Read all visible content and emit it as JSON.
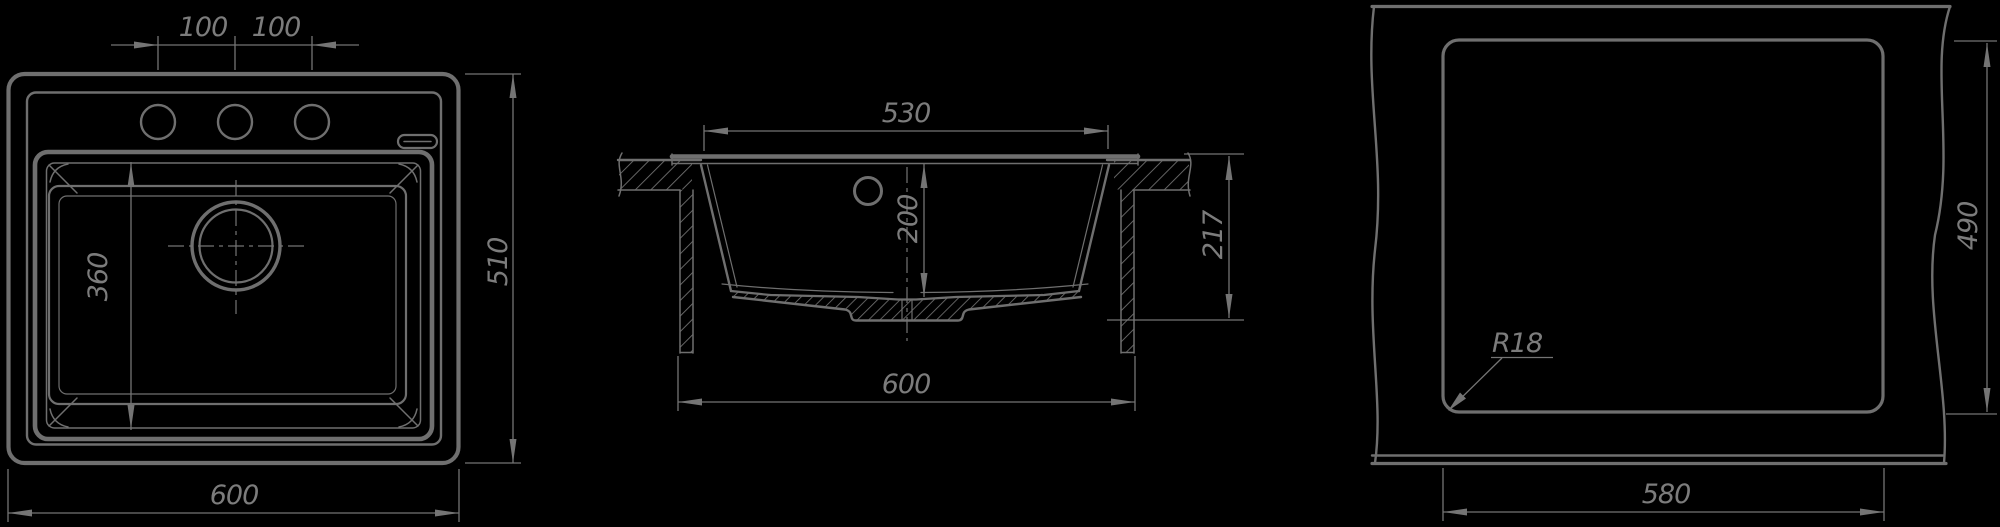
{
  "drawing": {
    "colors": {
      "background": "#000000",
      "line": "#6f6f6f",
      "dim_line": "#747474",
      "text": "#7c7c7c"
    },
    "views": {
      "top": {
        "dim_hole_pitch_left": "100",
        "dim_hole_pitch_right": "100",
        "dim_depth": "510",
        "dim_width": "600",
        "dim_bowl_front_to_back": "360"
      },
      "section": {
        "dim_bowl_top_width": "530",
        "dim_bowl_depth": "200",
        "dim_total_height": "217",
        "dim_width": "600"
      },
      "cutout": {
        "dim_width": "580",
        "dim_depth": "490",
        "dim_corner_radius": "R18"
      }
    }
  }
}
